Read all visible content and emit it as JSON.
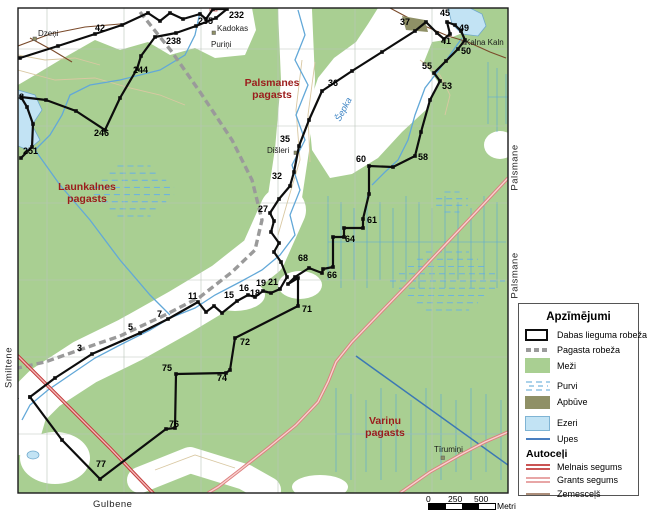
{
  "frame": {
    "left_label": "Smiltene",
    "bottom_label": "Gulbene",
    "right_label_upper": "Palsmane",
    "right_label_lower": "Palsmane"
  },
  "legend": {
    "title": "Apzīmējumi",
    "roads_subtitle": "Autoceļi",
    "items": [
      {
        "label": "Dabas lieguma robeža",
        "type": "reserve-boundary"
      },
      {
        "label": "Pagasta robeža",
        "type": "parish-boundary"
      },
      {
        "label": "Meži",
        "type": "forest"
      },
      {
        "label": "Purvi",
        "type": "swamp"
      },
      {
        "label": "Apbūve",
        "type": "built-up"
      },
      {
        "label": "Ezeri",
        "type": "lake"
      },
      {
        "label": "Upes",
        "type": "river"
      }
    ],
    "road_items": [
      {
        "label": "Melnais segums",
        "type": "paved"
      },
      {
        "label": "Grants segums",
        "type": "gravel"
      },
      {
        "label": "Zemesceļš",
        "type": "dirt"
      }
    ]
  },
  "scalebar": {
    "ticks": [
      "0",
      "250",
      "500"
    ],
    "unit": "Metri"
  },
  "map": {
    "colors": {
      "forest": "#a9cf92",
      "lake": "#c2e3f4",
      "water": "#62a8d8",
      "canal": "#3c78b4",
      "reserve_line": "#0d0d0d",
      "parish_text": "#9b1c1c",
      "road_red": "#c23b3b",
      "road_red_fill": "#f4b9b9",
      "road_pink": "#dd7e7e",
      "road_pink_fill": "#f8d2cf",
      "dirt_road": "#7a4a2a",
      "grey_road": "#9a9a9a",
      "contour": "#d9c8a2",
      "grid": "#b9c4b9",
      "built": "#8f9066"
    },
    "boundary_labels": [
      {
        "t": "1",
        "x": 14,
        "y": 399
      },
      {
        "t": "3",
        "x": 77,
        "y": 351
      },
      {
        "t": "5",
        "x": 128,
        "y": 330
      },
      {
        "t": "7",
        "x": 157,
        "y": 317
      },
      {
        "t": "11",
        "x": 188,
        "y": 299
      },
      {
        "t": "15",
        "x": 224,
        "y": 298
      },
      {
        "t": "16",
        "x": 239,
        "y": 291
      },
      {
        "t": "18",
        "x": 250,
        "y": 296
      },
      {
        "t": "19",
        "x": 256,
        "y": 286
      },
      {
        "t": "21",
        "x": 268,
        "y": 285
      },
      {
        "t": "27",
        "x": 258,
        "y": 212
      },
      {
        "t": "32",
        "x": 272,
        "y": 179
      },
      {
        "t": "35",
        "x": 280,
        "y": 142
      },
      {
        "t": "36",
        "x": 328,
        "y": 86
      },
      {
        "t": "37",
        "x": 400,
        "y": 25
      },
      {
        "t": "45",
        "x": 440,
        "y": 16
      },
      {
        "t": "49",
        "x": 459,
        "y": 31
      },
      {
        "t": "41",
        "x": 441,
        "y": 44
      },
      {
        "t": "50",
        "x": 461,
        "y": 54
      },
      {
        "t": "55",
        "x": 422,
        "y": 69
      },
      {
        "t": "53",
        "x": 442,
        "y": 89
      },
      {
        "t": "58",
        "x": 418,
        "y": 160
      },
      {
        "t": "60",
        "x": 356,
        "y": 162
      },
      {
        "t": "61",
        "x": 367,
        "y": 223
      },
      {
        "t": "64",
        "x": 345,
        "y": 242
      },
      {
        "t": "66",
        "x": 327,
        "y": 278
      },
      {
        "t": "68",
        "x": 298,
        "y": 261
      },
      {
        "t": "71",
        "x": 302,
        "y": 312
      },
      {
        "t": "72",
        "x": 240,
        "y": 345
      },
      {
        "t": "74",
        "x": 217,
        "y": 381
      },
      {
        "t": "75",
        "x": 162,
        "y": 371
      },
      {
        "t": "76",
        "x": 169,
        "y": 427
      },
      {
        "t": "77",
        "x": 96,
        "y": 467
      },
      {
        "t": "40",
        "x": 3,
        "y": 57
      },
      {
        "t": "42",
        "x": 95,
        "y": 31
      },
      {
        "t": "235",
        "x": 198,
        "y": 24
      },
      {
        "t": "232",
        "x": 229,
        "y": 18
      },
      {
        "t": "238",
        "x": 166,
        "y": 44
      },
      {
        "t": "244",
        "x": 133,
        "y": 73
      },
      {
        "t": "246",
        "x": 94,
        "y": 136
      },
      {
        "t": "248",
        "x": 9,
        "y": 100
      },
      {
        "t": "251",
        "x": 23,
        "y": 154
      }
    ],
    "place_labels": [
      {
        "t": "Dzeņi",
        "x": 38,
        "y": 36
      },
      {
        "t": "Kadokas",
        "x": 217,
        "y": 31
      },
      {
        "t": "Puriņi",
        "x": 211,
        "y": 47
      },
      {
        "t": "Dišleri",
        "x": 267,
        "y": 153
      },
      {
        "t": "Kalna Kaln",
        "x": 465,
        "y": 45
      },
      {
        "t": "Tīrumiņi",
        "x": 434,
        "y": 452
      }
    ],
    "pagasts_labels": [
      {
        "lines": [
          "Palsmanes",
          "pagasts"
        ],
        "x": 272,
        "y": 86
      },
      {
        "lines": [
          "Launkalnes",
          "pagasts"
        ],
        "x": 87,
        "y": 190
      },
      {
        "lines": [
          "Variņu",
          "pagasts"
        ],
        "x": 385,
        "y": 424
      }
    ],
    "river_label": {
      "t": "Šepka",
      "x": 340,
      "y": 122,
      "angle": -62
    }
  }
}
